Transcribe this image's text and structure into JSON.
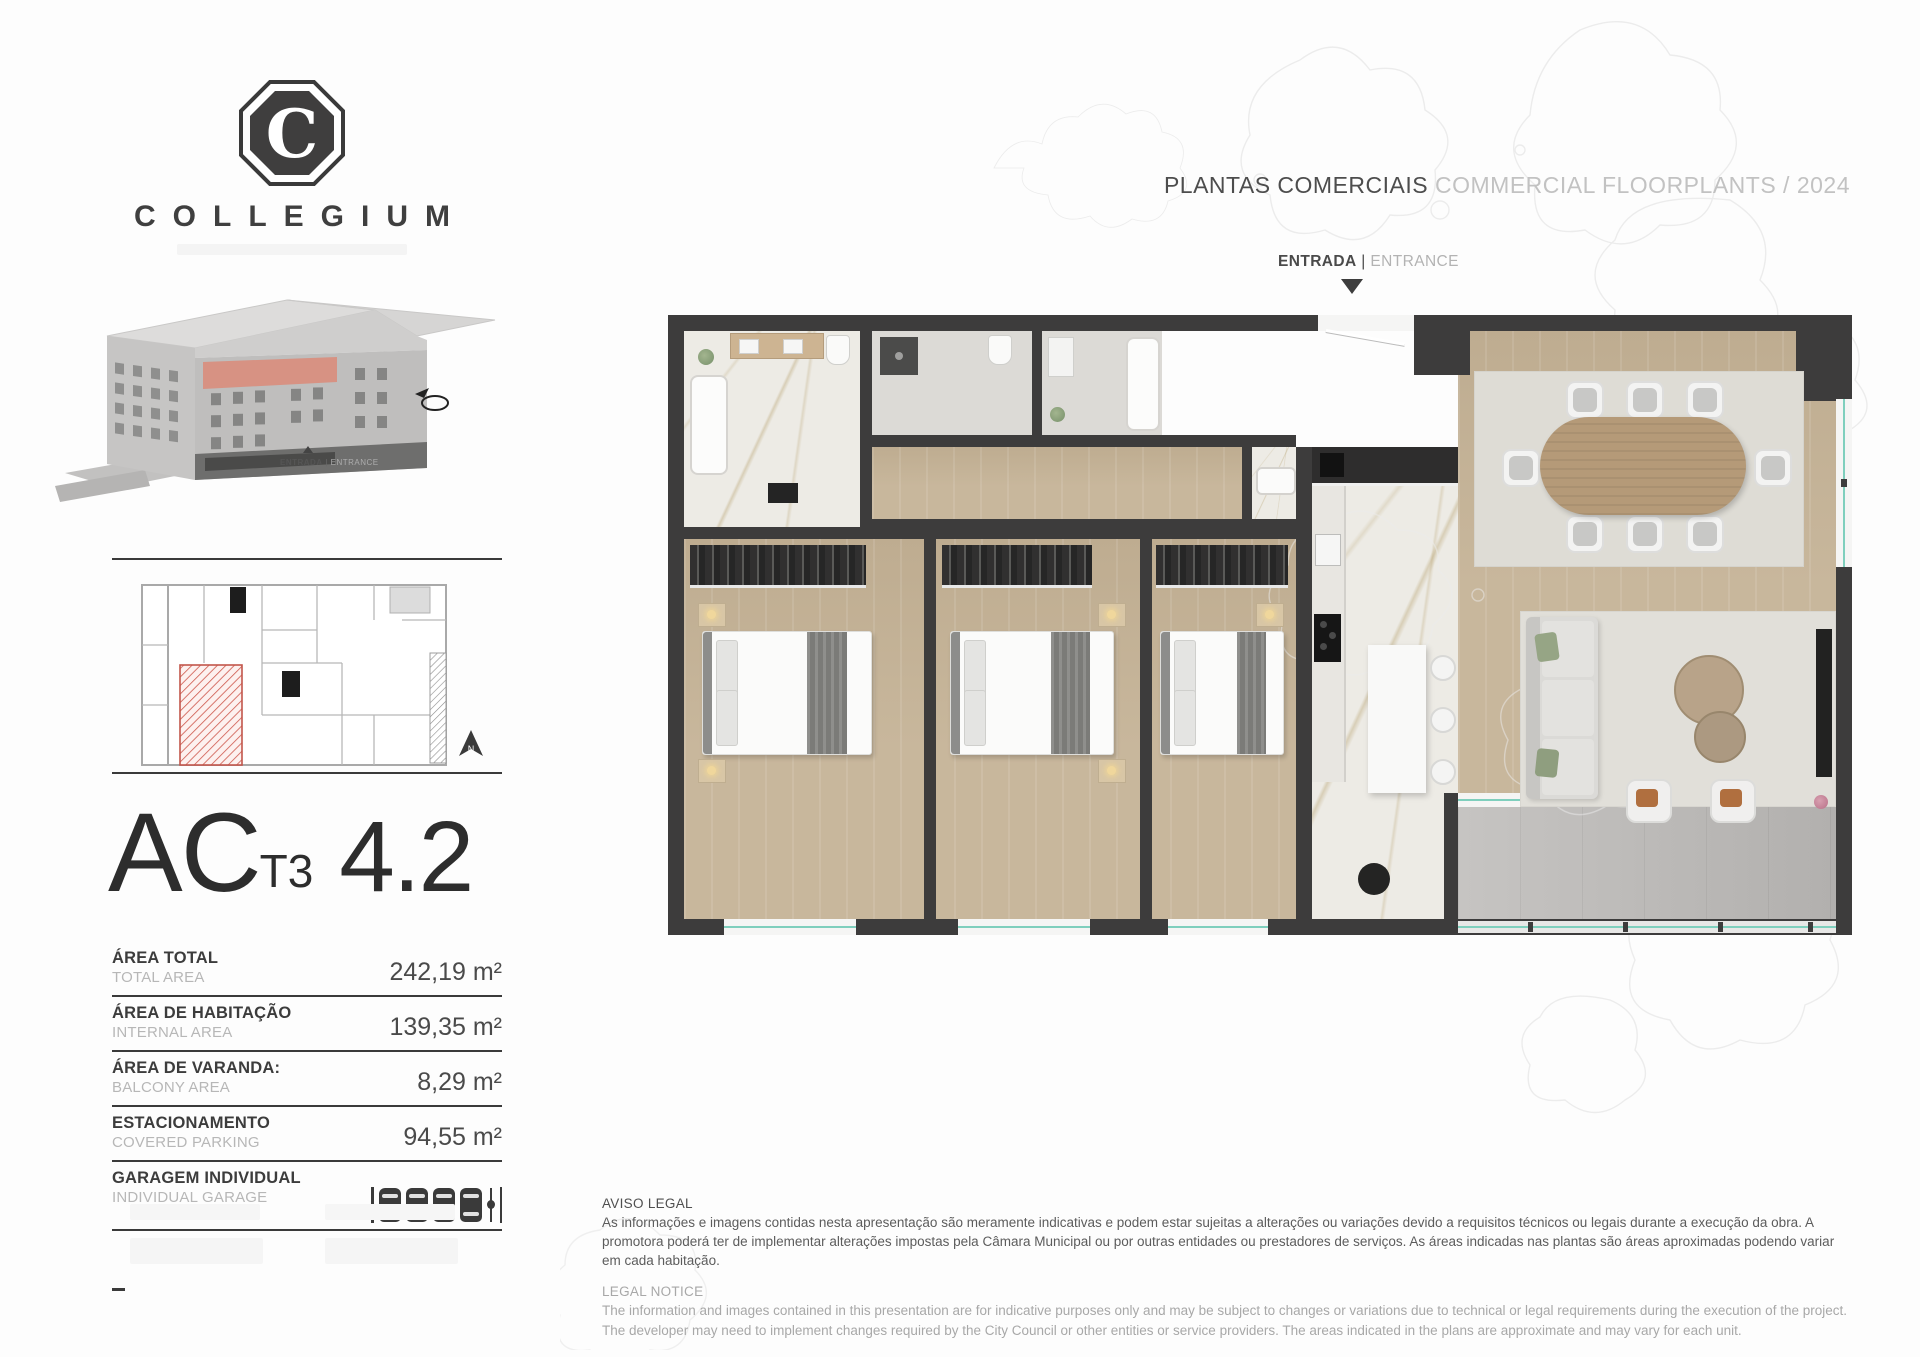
{
  "brand": {
    "name": "COLLEGIUM",
    "monogram": "C"
  },
  "header": {
    "title_pt": "PLANTAS COMERCIAIS",
    "title_en": "COMMERCIAL FLOORPLANTS / 2024"
  },
  "entrance": {
    "pt": "ENTRADA",
    "sep": " | ",
    "en": "ENTRANCE"
  },
  "building": {
    "entrance_pt": "ENTRADA",
    "entrance_sep": " | ",
    "entrance_en": "ENTRANCE"
  },
  "keyplan": {
    "north": "N"
  },
  "unit": {
    "code": "AC",
    "type": "T3",
    "number": "4.2"
  },
  "areas": [
    {
      "label_pt": "ÁREA TOTAL",
      "label_en": "TOTAL AREA",
      "value": "242,19 m²"
    },
    {
      "label_pt": "ÁREA DE HABITAÇÃO",
      "label_en": "INTERNAL AREA",
      "value": "139,35 m²"
    },
    {
      "label_pt": "ÁREA DE VARANDA:",
      "label_en": "BALCONY AREA",
      "value": "8,29 m²"
    },
    {
      "label_pt": "ESTACIONAMENTO",
      "label_en": "COVERED PARKING",
      "value": "94,55 m²"
    },
    {
      "label_pt": "GARAGEM INDIVIDUAL",
      "label_en": "INDIVIDUAL GARAGE",
      "value": ""
    }
  ],
  "garage": {
    "cars": 4,
    "motorcycles": 1
  },
  "legal": {
    "heading_pt": "AVISO LEGAL",
    "body_pt": "As informações e imagens contidas nesta apresentação são meramente indicativas e podem estar sujeitas a alterações ou variações devido a requisitos técnicos ou legais durante a execução da obra. A promotora poderá ter de implementar alterações impostas pela Câmara Municipal ou por outras entidades ou prestadores de serviços. As áreas indicadas nas plantas são áreas aproximadas podendo variar em cada habitação.",
    "heading_en": "LEGAL NOTICE",
    "body_en": "The information and images contained in this presentation are for indicative purposes only and may be subject to changes or variations due to technical or legal requirements during the execution of the project. The developer may need to implement changes required by the City Council or other entities or service providers. The areas indicated in the plans are approximate and may vary for each unit."
  },
  "colors": {
    "accent_salmon": "#d98d7c",
    "unit_hatch_red": "#cf5a4e",
    "wall_dark": "#3d3c3c",
    "wood_floor": "#c8b79c",
    "marble_floor": "#edebe5",
    "concrete_floor": "#bab8b6",
    "glass_teal": "#7fcfbd",
    "text_dark": "#3c3c3c",
    "text_light": "#b7b7b7"
  }
}
